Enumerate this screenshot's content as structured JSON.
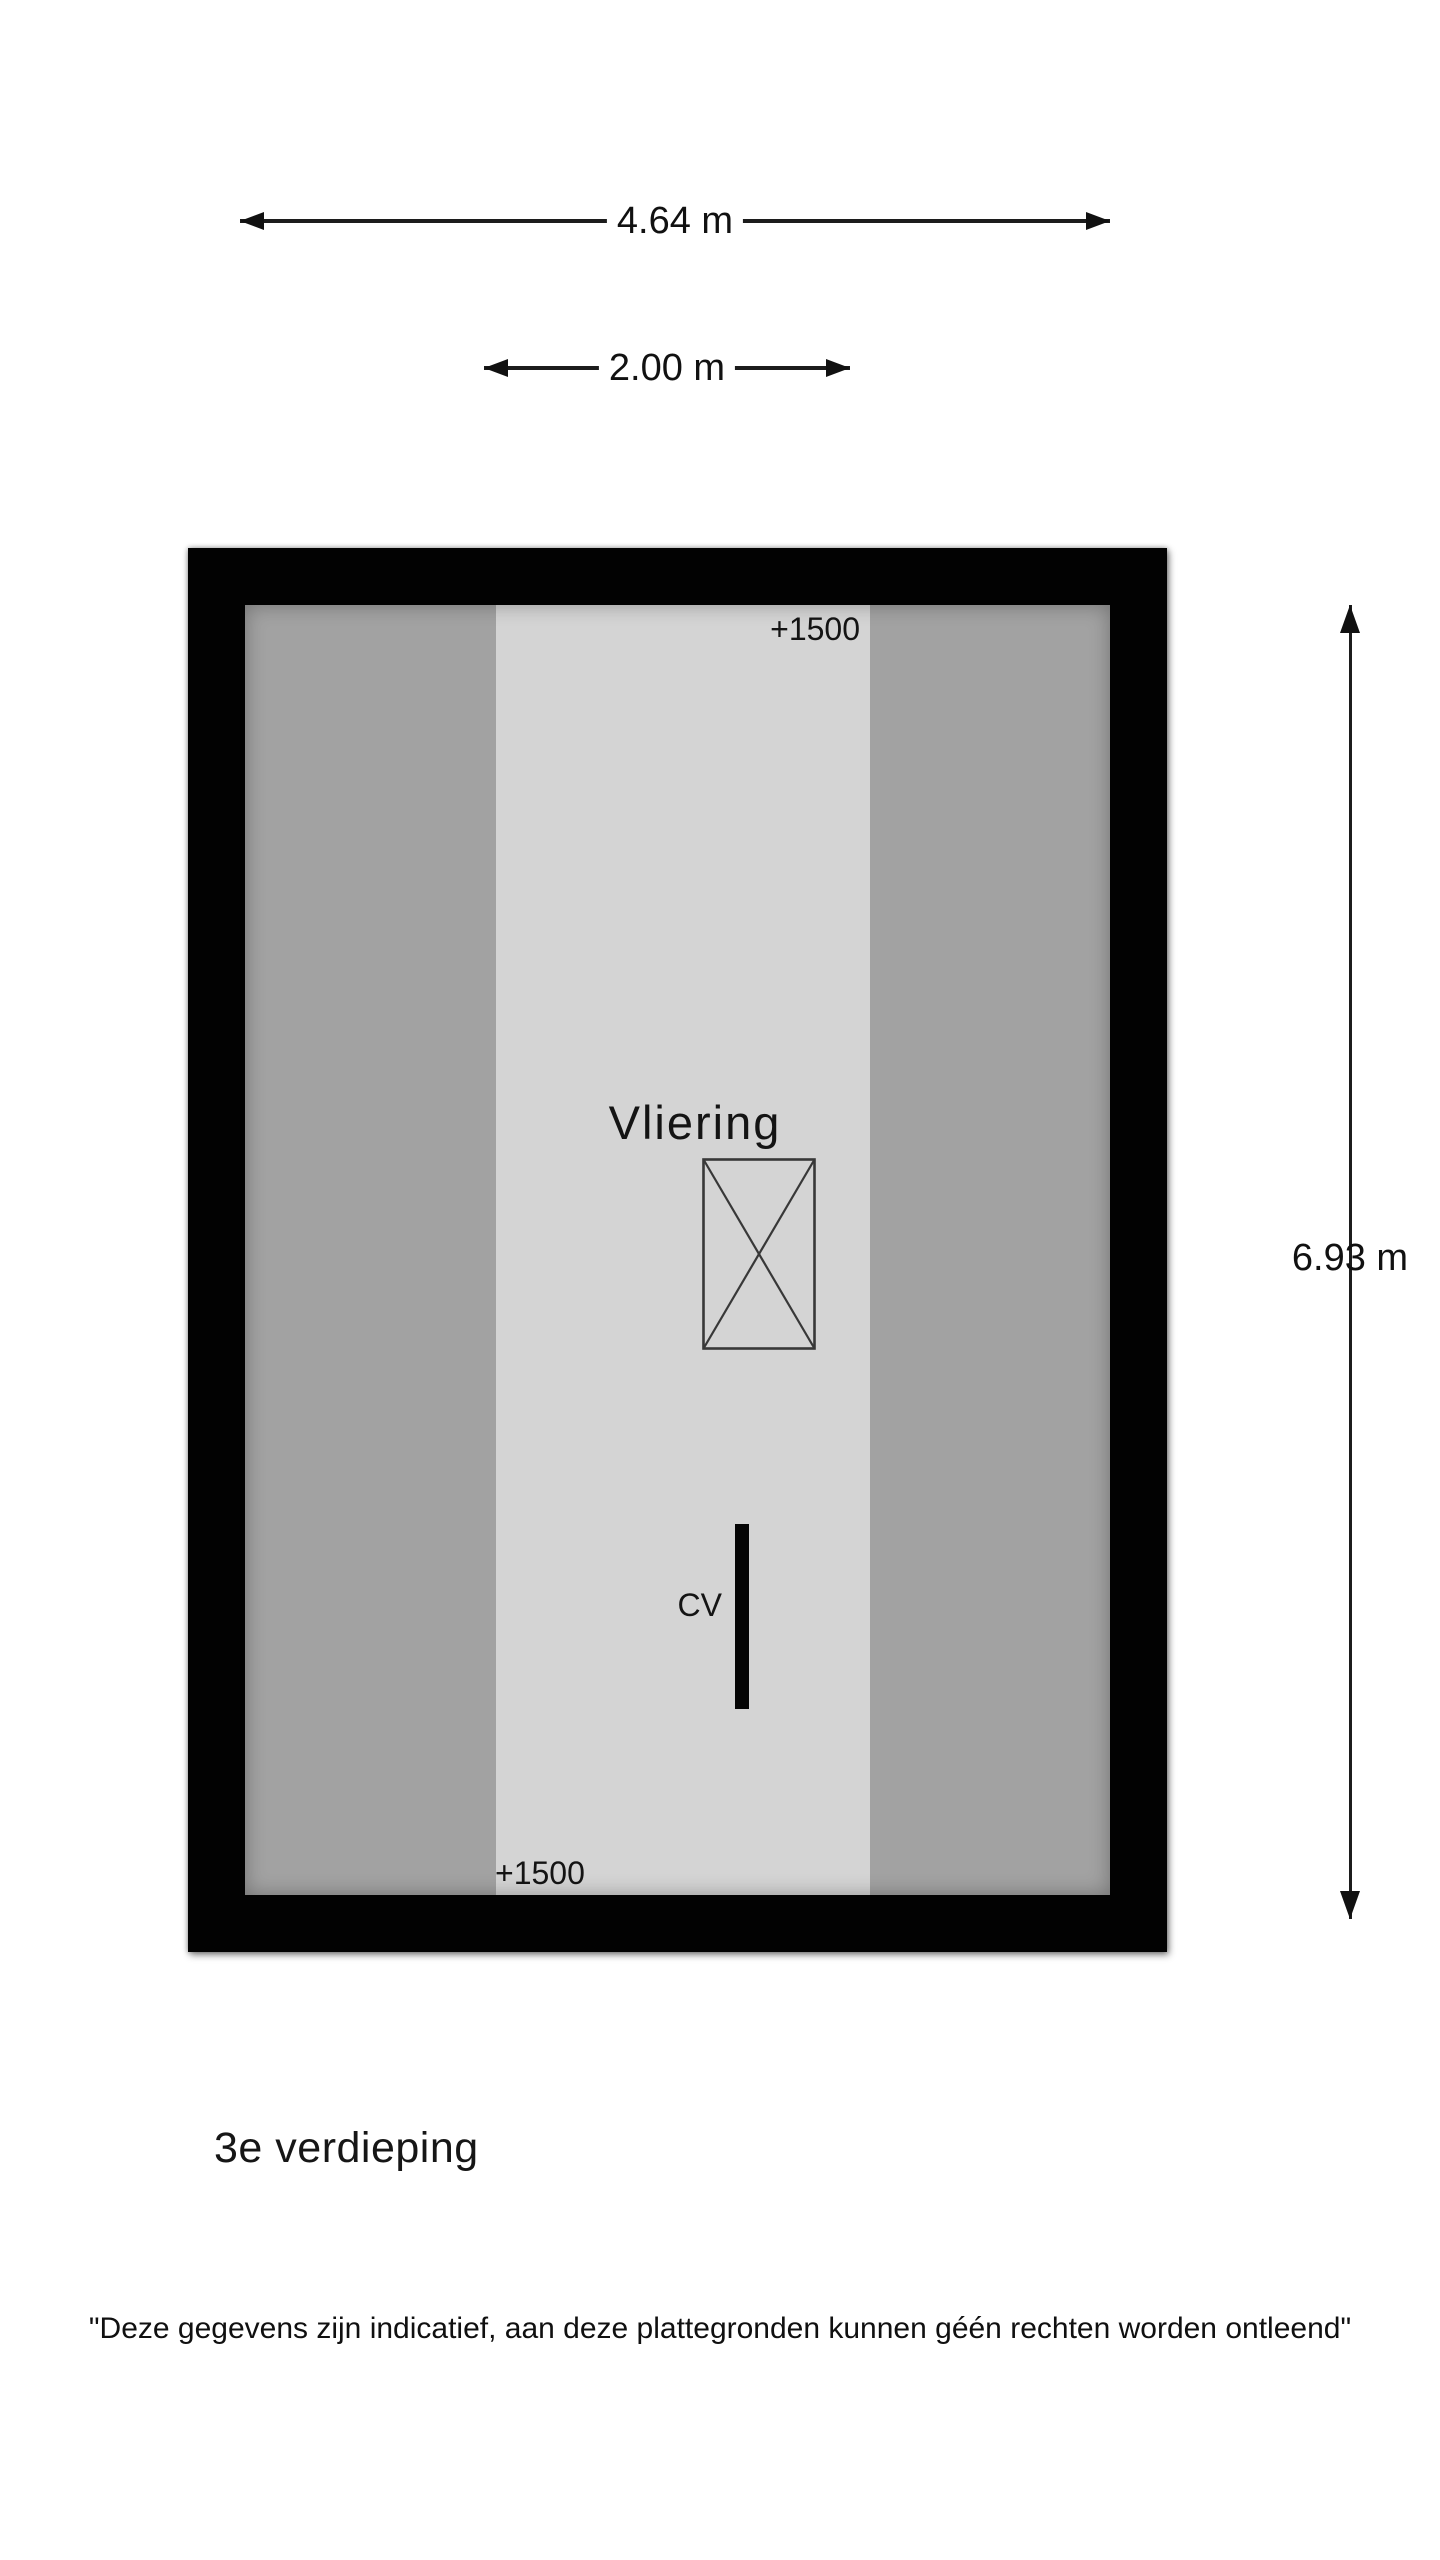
{
  "plan": {
    "room": {
      "name": "Vliering",
      "cv_label": "CV",
      "height_marker_top": "+1500",
      "height_marker_bottom": "+1500"
    },
    "colors": {
      "wall": "#020202",
      "floor_low_headroom": "#a2a2a2",
      "floor_high_headroom": "#d4d4d4",
      "dimension_line": "#1c1c1c"
    }
  },
  "dimensions": {
    "total_width_label": "4.64 m",
    "center_width_label": "2.00 m",
    "total_depth_label": "6.93 m"
  },
  "floor_title": "3e verdieping",
  "disclaimer": "\"Deze gegevens zijn indicatief, aan deze plattegronden kunnen géén rechten worden ontleend\""
}
